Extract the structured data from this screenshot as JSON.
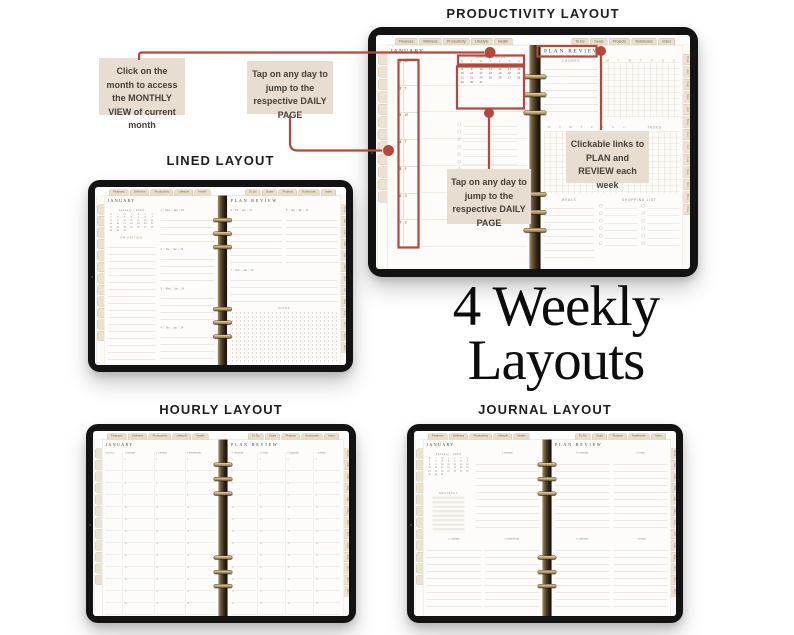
{
  "headings": {
    "productivity": "PRODUCTIVITY LAYOUT",
    "lined": "LINED LAYOUT",
    "hourly": "HOURLY LAYOUT",
    "journal": "JOURNAL LAYOUT"
  },
  "center_title": {
    "line1": "4 Weekly",
    "line2": "Layouts"
  },
  "callouts": {
    "monthly_view": "Click on the month to access the MONTHLY VIEW of current month",
    "daily_top": "Tap on any day to jump to the respective DAILY PAGE",
    "daily_bottom": "Tap on any day to jump to the respective DAILY PAGE",
    "plan_review": "Clickable links to PLAN and REVIEW each week"
  },
  "colors": {
    "annotation_red": "#b5473c",
    "callout_bg": "#e7ded1",
    "bezel_black": "#131313",
    "tab_beige": "#e9dfcc",
    "binding_brown": "#4a3b26"
  },
  "planner_common": {
    "top_tabs_left": [
      "Finances",
      "Wellness",
      "Productivity",
      "Lifestyle",
      "Health"
    ],
    "top_tabs_right": [
      "To Do",
      "Goals",
      "Projects",
      "Notebooks",
      "Index"
    ],
    "month_tabs": [
      "Plan",
      "Jan",
      "Feb",
      "Mar",
      "Apr",
      "May",
      "Jun",
      "Jul",
      "Aug",
      "Sep",
      "Oct",
      "Nov",
      "Dec"
    ],
    "month_title": "JANUARY",
    "review_title": "PLAN  REVIEW",
    "mini_calendar": {
      "header": "January - 2024",
      "weekdays": [
        "M",
        "T",
        "W",
        "T",
        "F",
        "S",
        "S"
      ],
      "days": [
        "1",
        "2",
        "3",
        "4",
        "5",
        "6",
        "7",
        "8",
        "9",
        "10",
        "11",
        "12",
        "13",
        "14",
        "15",
        "16",
        "17",
        "18",
        "19",
        "20",
        "21",
        "22",
        "23",
        "24",
        "25",
        "26",
        "27",
        "28",
        "29",
        "30",
        "31"
      ]
    }
  },
  "productivity": {
    "day_column": [
      {
        "n": "1",
        "d": "M"
      },
      {
        "n": "2",
        "d": "T"
      },
      {
        "n": "3",
        "d": "W"
      },
      {
        "n": "4",
        "d": "T"
      },
      {
        "n": "5",
        "d": "F"
      },
      {
        "n": "6",
        "d": "S"
      },
      {
        "n": "7",
        "d": "S"
      }
    ],
    "chores_label": "CHORES",
    "week_letters": [
      "M",
      "T",
      "W",
      "T",
      "F",
      "S",
      "S"
    ],
    "plus": "+",
    "tasks_label": "TASKS",
    "meals_label": "MEALS",
    "shopping_label": "SHOPPING LIST"
  },
  "lined": {
    "priorities_label": "PRIORITIES",
    "notes_label": "NOTES",
    "left_days": [
      {
        "n": "1",
        "d": "Mon",
        "m": "Jan",
        "y": "24"
      },
      {
        "n": "2",
        "d": "Tue",
        "m": "Jan",
        "y": "24"
      },
      {
        "n": "3",
        "d": "Wed",
        "m": "Jan",
        "y": "24"
      },
      {
        "n": "4",
        "d": "Thu",
        "m": "Jan",
        "y": "24"
      }
    ],
    "right_days": [
      {
        "n": "5",
        "d": "Fri",
        "m": "Jan",
        "y": "24"
      },
      {
        "n": "6",
        "d": "Sat",
        "m": "Jan",
        "y": "24"
      }
    ],
    "right_day_full": {
      "n": "7",
      "d": "Sun",
      "m": "Jan",
      "y": "24"
    }
  },
  "hourly": {
    "left_columns": [
      "HOURS",
      "1 Monday",
      "2 Tuesday",
      "3 Wednesday"
    ],
    "right_columns": [
      "4 Thursday",
      "5 Friday",
      "6 Saturday",
      "7 Sunday"
    ],
    "hours": [
      "6",
      "7",
      "8",
      "9",
      "10",
      "11",
      "12",
      "13",
      "14",
      "15",
      "16",
      "17",
      "18"
    ]
  },
  "journal": {
    "grateful_label": "GRATEFUL",
    "left_top_day": "1 Monday",
    "left_bottom_days": [
      "2 Tuesday",
      "3 Wednesday"
    ],
    "right_top_days": [
      "4 Thursday",
      "5 Friday"
    ],
    "right_bottom_days": [
      "6 Saturday",
      "7 Sunday"
    ]
  }
}
